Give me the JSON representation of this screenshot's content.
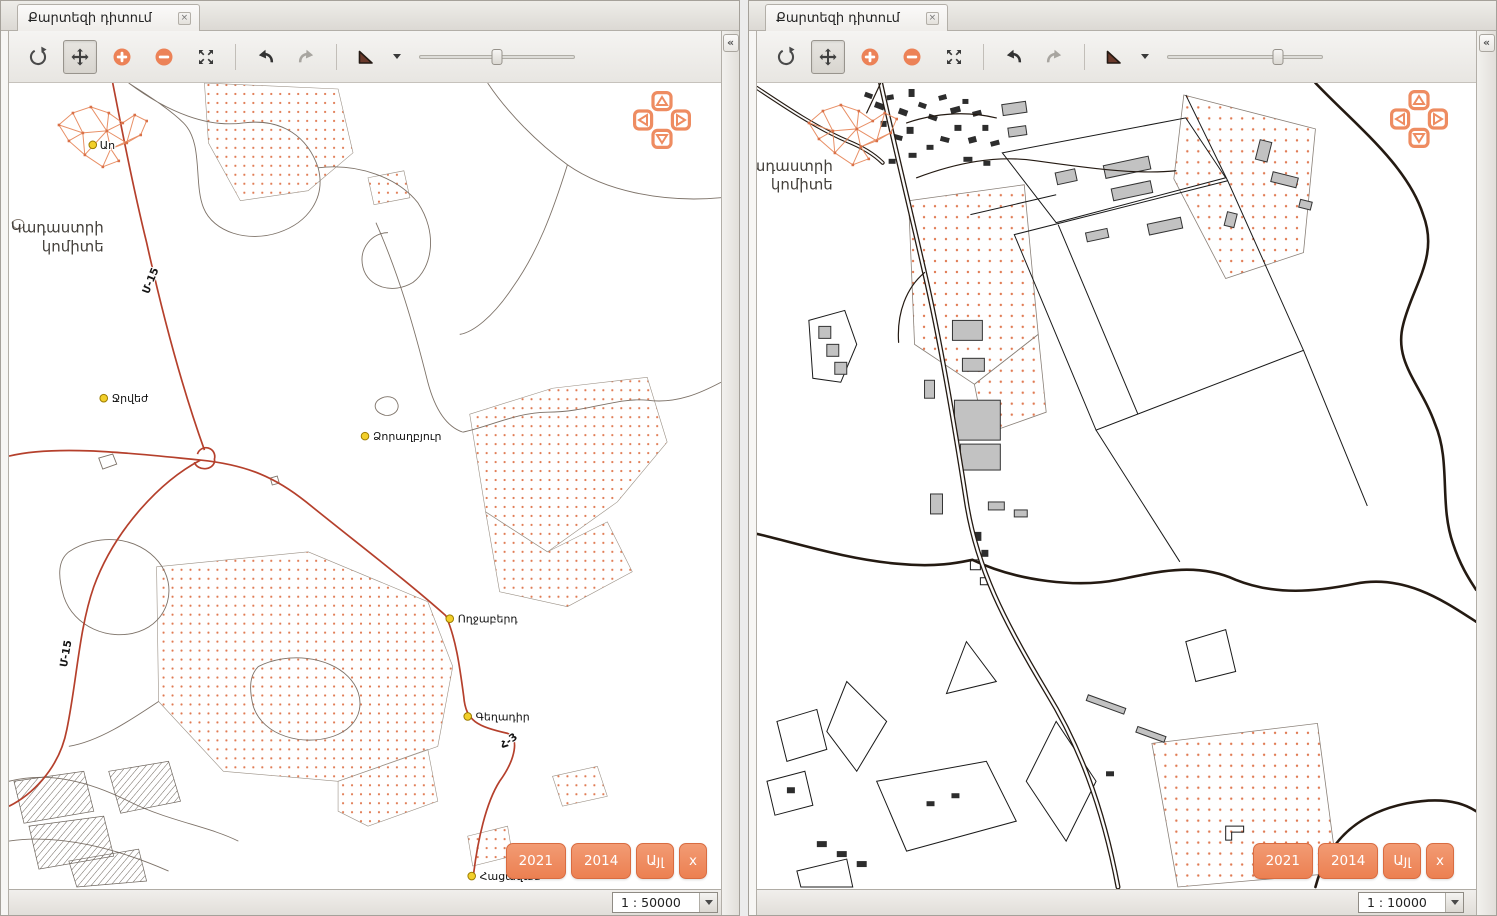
{
  "colors": {
    "accent_orange": "#ee8659",
    "button_orange": "#ec8052",
    "road_red": "#b5402c",
    "stipple_orange": "#e07a52",
    "dark_line": "#241a12",
    "gray_line": "#7d7268",
    "building_gray": "#c2c2c2",
    "marker_yellow": "#f2cf2a"
  },
  "toolbar_icons": [
    "refresh-icon",
    "pan-icon",
    "zoom-in-icon",
    "zoom-out-icon",
    "zoom-extent-icon",
    "undo-icon",
    "redo-icon",
    "measure-flag-icon",
    "zoom-slider"
  ],
  "panels": [
    {
      "id": "left",
      "tab": {
        "title": "Քարտեզի դիտում",
        "close_label": "×"
      },
      "toolbar": {
        "zoom_slider_pct": 50
      },
      "collapse_label": "«",
      "map": {
        "scale_label": "1 : 50000",
        "watermark": {
          "line1": "Կադաստրի",
          "line2": "կոմիտե"
        },
        "places": [
          {
            "label": "Աո"
          },
          {
            "label": "Ջրվեժ"
          },
          {
            "label": "Ձորաղբյուր"
          },
          {
            "label": "Ողջաբերդ"
          },
          {
            "label": "Գեղադիր"
          },
          {
            "label": "Հացավան"
          }
        ],
        "road_labels": [
          {
            "text": "Մ-15"
          },
          {
            "text": "Մ-15"
          },
          {
            "text": "Հ-3"
          }
        ],
        "year_buttons": [
          {
            "label": "2021"
          },
          {
            "label": "2014"
          },
          {
            "label": "Այլ"
          },
          {
            "label": "x"
          }
        ]
      }
    },
    {
      "id": "right",
      "tab": {
        "title": "Քարտեզի դիտում",
        "close_label": "×"
      },
      "toolbar": {
        "zoom_slider_pct": 71
      },
      "collapse_label": "«",
      "map": {
        "scale_label": "1 : 10000",
        "watermark": {
          "line1": "Կադաստրի",
          "line2": "կոմիտե"
        },
        "places": [],
        "road_labels": [],
        "year_buttons": [
          {
            "label": "2021"
          },
          {
            "label": "2014"
          },
          {
            "label": "Այլ"
          },
          {
            "label": "x"
          }
        ]
      }
    }
  ]
}
